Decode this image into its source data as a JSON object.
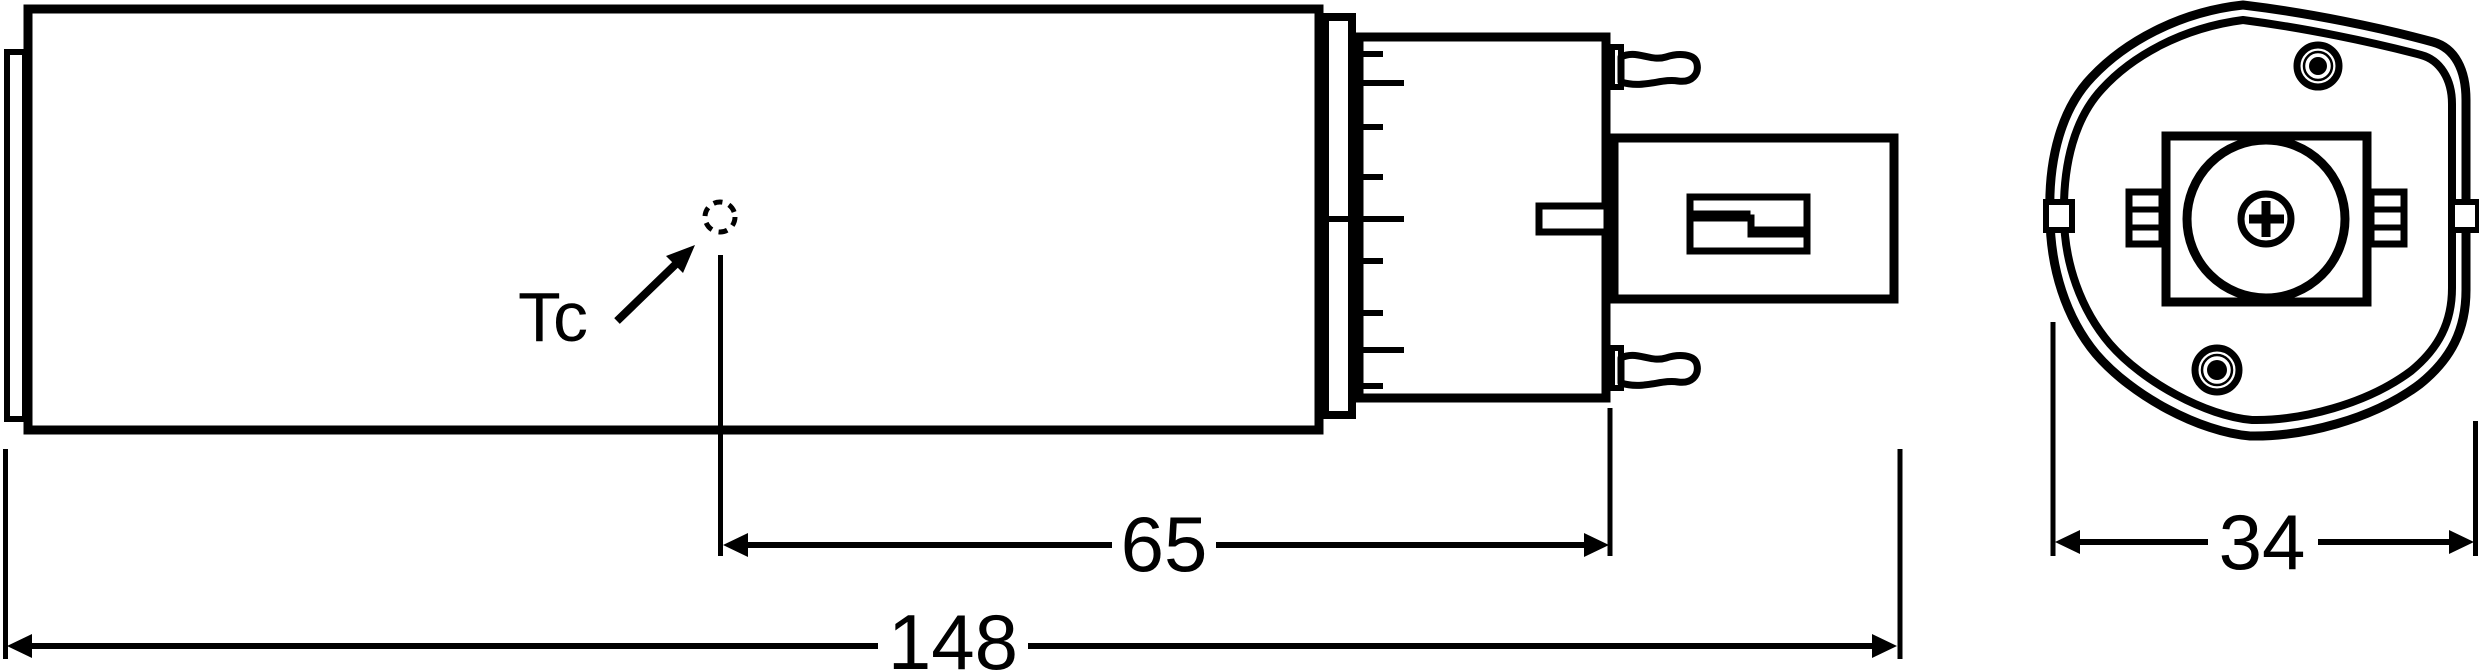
{
  "labels": {
    "thermal_point": "Tc"
  },
  "dimensions": {
    "tc_to_base_end": "65",
    "overall_length": "148",
    "housing_width": "34"
  },
  "colors": {
    "line": "#000000",
    "background": "#ffffff"
  }
}
